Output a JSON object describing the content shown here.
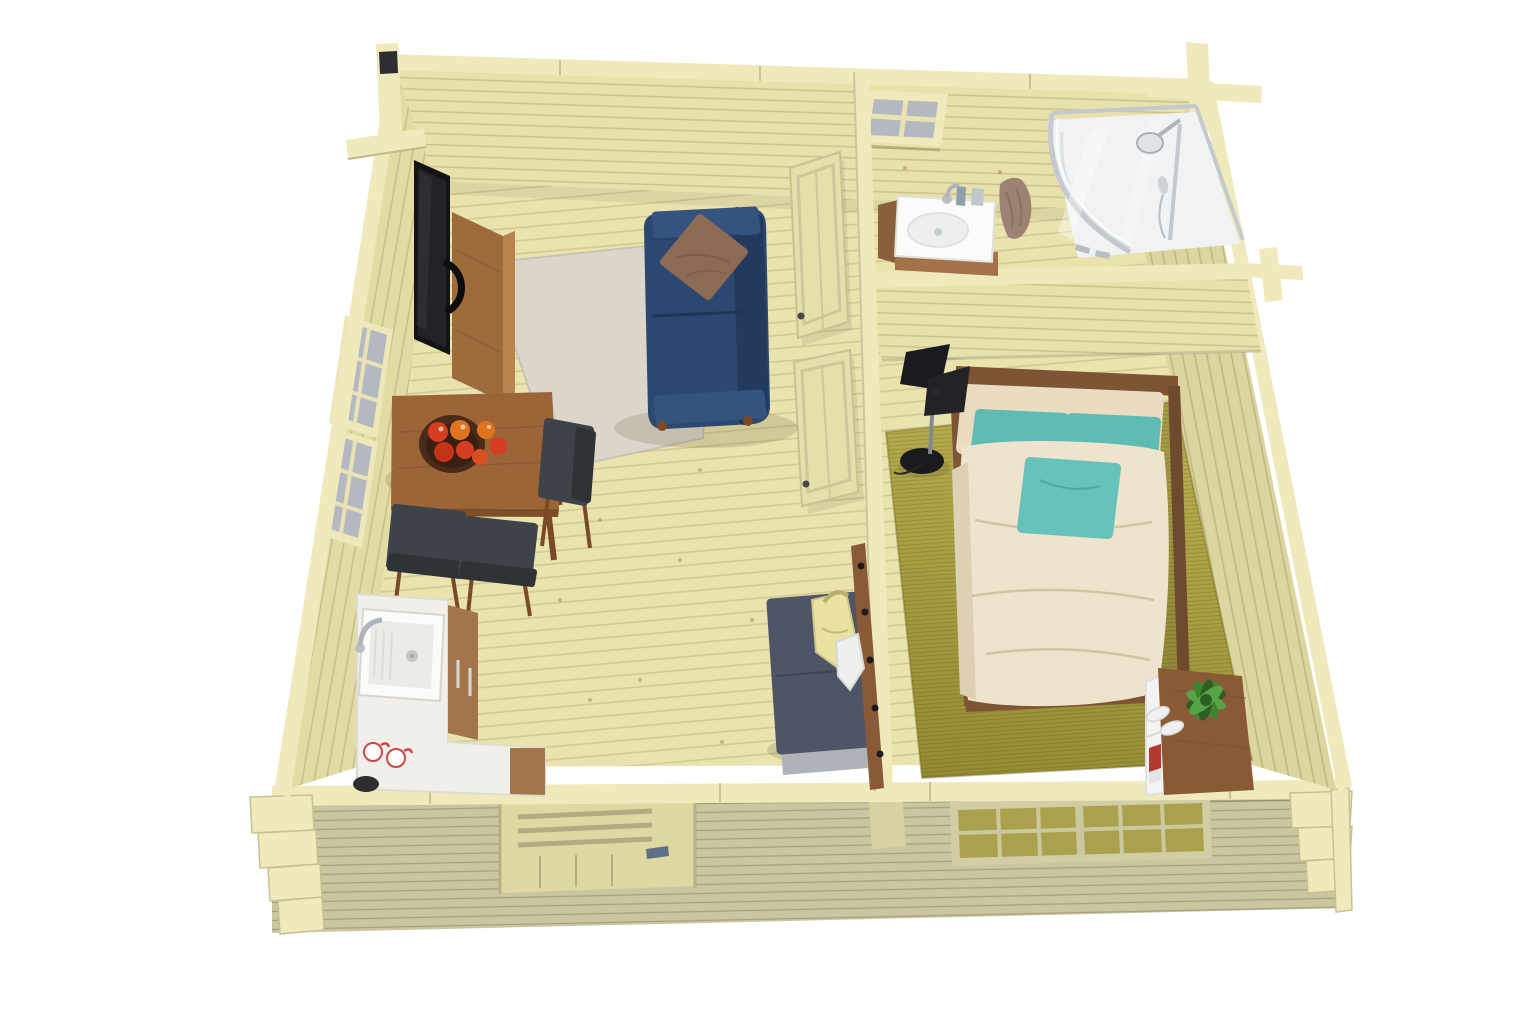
{
  "scene": {
    "subject": "log-cabin-interior-top-down-cutaway-render",
    "rooms": [
      {
        "id": "living-room-kitchen",
        "items": [
          "flat-tv",
          "tv-sideboard",
          "navy-sofa",
          "throw-pillow",
          "beige-area-rug",
          "dining-table",
          "fruit-bowl-with-apples",
          "dining-chairs",
          "kitchen-corner-counter",
          "kitchen-sink",
          "mugs",
          "storage-bench",
          "coat-rack-with-bag",
          "entrance-door"
        ]
      },
      {
        "id": "bathroom",
        "items": [
          "washbasin-vanity",
          "faucet",
          "toiletries",
          "towel",
          "corner-shower-cabin",
          "small-window"
        ]
      },
      {
        "id": "bedroom",
        "items": [
          "double-bed",
          "beige-pillows",
          "teal-pillows",
          "cream-duvet",
          "floor-lamp",
          "olive-area-rug",
          "nightstand-shelf",
          "potted-plant",
          "books",
          "slippers",
          "front-window"
        ]
      }
    ],
    "openings": [
      "left-wall-window-upper",
      "left-wall-window-lower",
      "bathroom-door-open",
      "bedroom-door-open"
    ]
  },
  "colors": {
    "background": "#ffffff",
    "wall_wood": "#e8e1ac",
    "wall_wood_left": "#e3dba4",
    "wall_wood_right": "#ddd5a0",
    "wall_cap": "#f0e9bb",
    "floor_wood": "#eae3ae",
    "exterior_wall": "#c9c6a0",
    "door_wood": "#e0d8a2",
    "door_leaf": "#e6dfaa",
    "window_pane": "#b4b8c0",
    "window_pane_yellow": "#a9a14e",
    "tv_black": "#141416",
    "tv_screen": "#232327",
    "sideboard_wood": "#9e6b3c",
    "sideboard_wood_light": "#b8834e",
    "sofa_navy": "#2d4870",
    "sofa_navy_dark": "#223a5e",
    "sofa_navy_light": "#35537f",
    "cushion_brown": "#8c6a54",
    "rug_living": "#d8d2c4",
    "table_wood": "#9c6538",
    "table_edge": "#7f4e29",
    "leg_wood": "#7a4a28",
    "chair_gray": "#3e434a",
    "chair_gray_dark": "#2f3338",
    "counter_white": "#f1efe9",
    "sink_white": "#fbfbfa",
    "basin_inner": "#ebebe8",
    "cabinet_wood": "#a4744a",
    "bench_gray": "#4f5466",
    "bench_base": "#aeb3ba",
    "bag_yellow": "#e9e2a0",
    "cloth_white": "#eef0ee",
    "vanity_wood": "#a3714a",
    "vanity_wood_dark": "#8a5f3c",
    "towel_mauve": "#9d8173",
    "glass_white": "#f0f2f3",
    "chrome": "#b9bec2",
    "rug_bedroom": "#b8ad4e",
    "rug_bedroom_dark": "#938a33",
    "bed_frame": "#7d5434",
    "bed_frame_dark": "#6e4a2e",
    "duvet_cream": "#eee4ce",
    "duvet_shade": "#ddd0b4",
    "pillow_beige": "#e9dcc0",
    "pillow_teal": "#5fbcb4",
    "pillow_teal_light": "#66c2ba",
    "lamp_black": "#1b1b1f",
    "lamp_black2": "#232327",
    "pole_gray": "#85898d",
    "nightstand_wood": "#8a5a36",
    "shelf_white": "#f4f3f1",
    "plant_green": "#3f8432",
    "plant_green_dark": "#2c5f22",
    "plant_green_light": "#57a447",
    "apple_red": "#d63d22",
    "apple_red2": "#c23318",
    "apple_orange": "#e0741d",
    "book_red": "#b43a2e",
    "book_white": "#e3e4e6",
    "bowl_brown": "#4a2b1a",
    "post_dark": "#2e2e32",
    "shadow": "rgba(80,70,35,0.16)"
  }
}
